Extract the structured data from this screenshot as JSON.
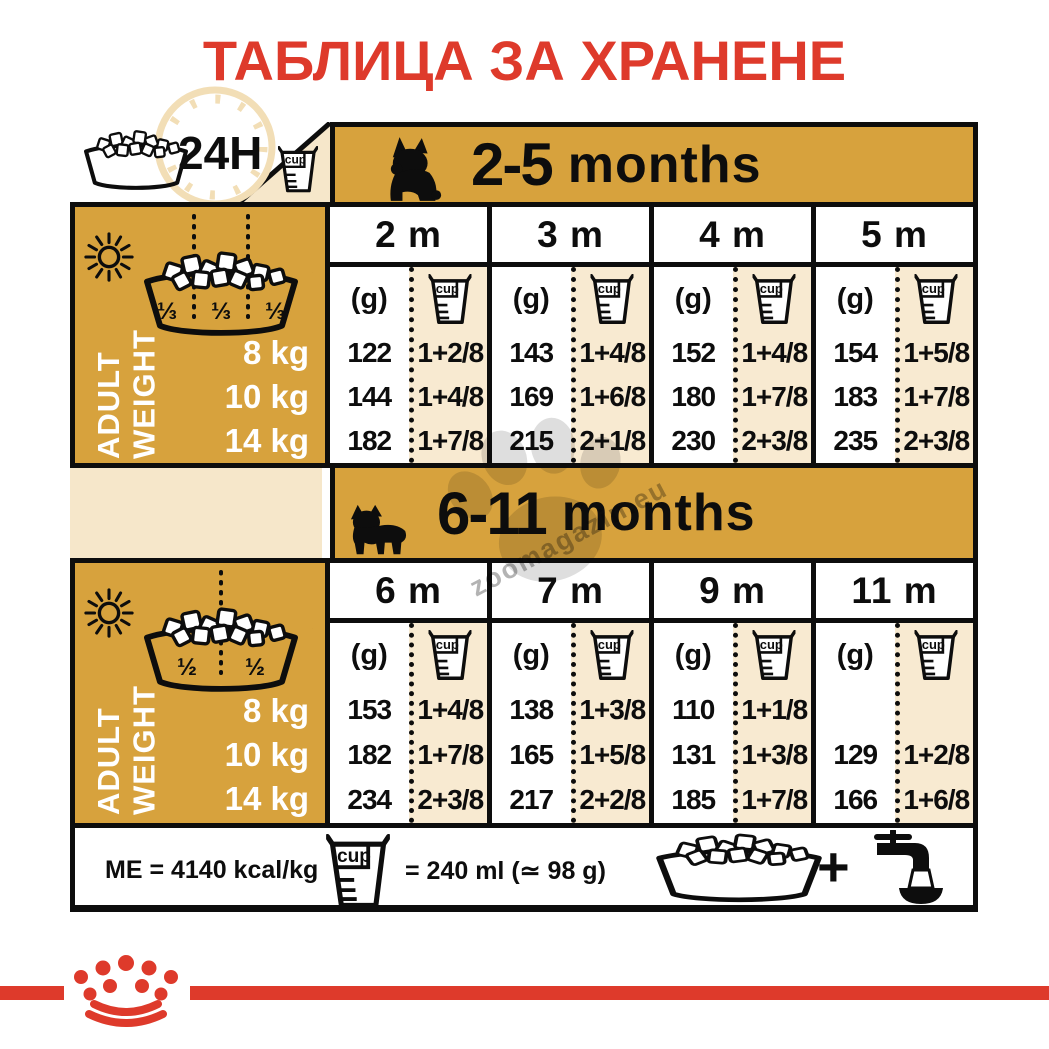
{
  "title": "ТАБЛИЦА ЗА ХРАНЕНЕ",
  "labels": {
    "cup": "cup",
    "g": "(g)",
    "hours": "24H"
  },
  "colors": {
    "gold": "#D7A23D",
    "cream": "#F6E7CA",
    "cup_column": "#F8EAD1",
    "red": "#DE3A2B",
    "black": "#0d0d0d"
  },
  "watermark": "zoomagazin.eu",
  "sections": [
    {
      "range": "2-5",
      "months_word": "months",
      "columns": [
        "2 m",
        "3 m",
        "4 m",
        "5 m"
      ],
      "bowl_fractions": [
        "⅓",
        "⅓",
        "⅓"
      ],
      "side_label": "ADULT\nWEIGHT",
      "weights": [
        "8 kg",
        "10 kg",
        "14 kg"
      ],
      "rows": [
        {
          "weight": "8 kg",
          "cells": [
            {
              "g": "122",
              "cup": "1+2/8"
            },
            {
              "g": "143",
              "cup": "1+4/8"
            },
            {
              "g": "152",
              "cup": "1+4/8"
            },
            {
              "g": "154",
              "cup": "1+5/8"
            }
          ]
        },
        {
          "weight": "10 kg",
          "cells": [
            {
              "g": "144",
              "cup": "1+4/8"
            },
            {
              "g": "169",
              "cup": "1+6/8"
            },
            {
              "g": "180",
              "cup": "1+7/8"
            },
            {
              "g": "183",
              "cup": "1+7/8"
            }
          ]
        },
        {
          "weight": "14 kg",
          "cells": [
            {
              "g": "182",
              "cup": "1+7/8"
            },
            {
              "g": "215",
              "cup": "2+1/8"
            },
            {
              "g": "230",
              "cup": "2+3/8"
            },
            {
              "g": "235",
              "cup": "2+3/8"
            }
          ]
        }
      ]
    },
    {
      "range": "6-11",
      "months_word": "months",
      "columns": [
        "6 m",
        "7 m",
        "9 m",
        "11 m"
      ],
      "bowl_fractions": [
        "½",
        "½"
      ],
      "side_label": "ADULT\nWEIGHT",
      "weights": [
        "8 kg",
        "10 kg",
        "14 kg"
      ],
      "rows": [
        {
          "weight": "8 kg",
          "cells": [
            {
              "g": "153",
              "cup": "1+4/8"
            },
            {
              "g": "138",
              "cup": "1+3/8"
            },
            {
              "g": "110",
              "cup": "1+1/8"
            },
            {
              "g": "",
              "cup": ""
            }
          ]
        },
        {
          "weight": "10 kg",
          "cells": [
            {
              "g": "182",
              "cup": "1+7/8"
            },
            {
              "g": "165",
              "cup": "1+5/8"
            },
            {
              "g": "131",
              "cup": "1+3/8"
            },
            {
              "g": "129",
              "cup": "1+2/8"
            }
          ]
        },
        {
          "weight": "14 kg",
          "cells": [
            {
              "g": "234",
              "cup": "2+3/8"
            },
            {
              "g": "217",
              "cup": "2+2/8"
            },
            {
              "g": "185",
              "cup": "1+7/8"
            },
            {
              "g": "166",
              "cup": "1+6/8"
            }
          ]
        }
      ]
    }
  ],
  "footer": {
    "me": "ME = 4140 kcal/kg",
    "cup_eq": "= 240 ml (≃ 98 g)",
    "plus": "+"
  },
  "chart_data": [
    {
      "type": "table",
      "title": "2-5 months",
      "columns": [
        "2 m",
        "3 m",
        "4 m",
        "5 m"
      ],
      "row_labels": [
        "8 kg",
        "10 kg",
        "14 kg"
      ],
      "units": [
        "g",
        "cup"
      ],
      "grams": [
        [
          122,
          143,
          152,
          154
        ],
        [
          144,
          169,
          180,
          183
        ],
        [
          182,
          215,
          230,
          235
        ]
      ],
      "cups": [
        [
          "1+2/8",
          "1+4/8",
          "1+4/8",
          "1+5/8"
        ],
        [
          "1+4/8",
          "1+6/8",
          "1+7/8",
          "1+7/8"
        ],
        [
          "1+7/8",
          "2+1/8",
          "2+3/8",
          "2+3/8"
        ]
      ],
      "daily_split": "1/3 + 1/3 + 1/3"
    },
    {
      "type": "table",
      "title": "6-11 months",
      "columns": [
        "6 m",
        "7 m",
        "9 m",
        "11 m"
      ],
      "row_labels": [
        "8 kg",
        "10 kg",
        "14 kg"
      ],
      "units": [
        "g",
        "cup"
      ],
      "grams": [
        [
          153,
          138,
          110,
          null
        ],
        [
          182,
          165,
          131,
          129
        ],
        [
          234,
          217,
          185,
          166
        ]
      ],
      "cups": [
        [
          "1+4/8",
          "1+3/8",
          "1+1/8",
          ""
        ],
        [
          "1+7/8",
          "1+5/8",
          "1+3/8",
          "1+2/8"
        ],
        [
          "2+3/8",
          "2+2/8",
          "1+7/8",
          "1+6/8"
        ]
      ],
      "daily_split": "1/2 + 1/2"
    }
  ]
}
